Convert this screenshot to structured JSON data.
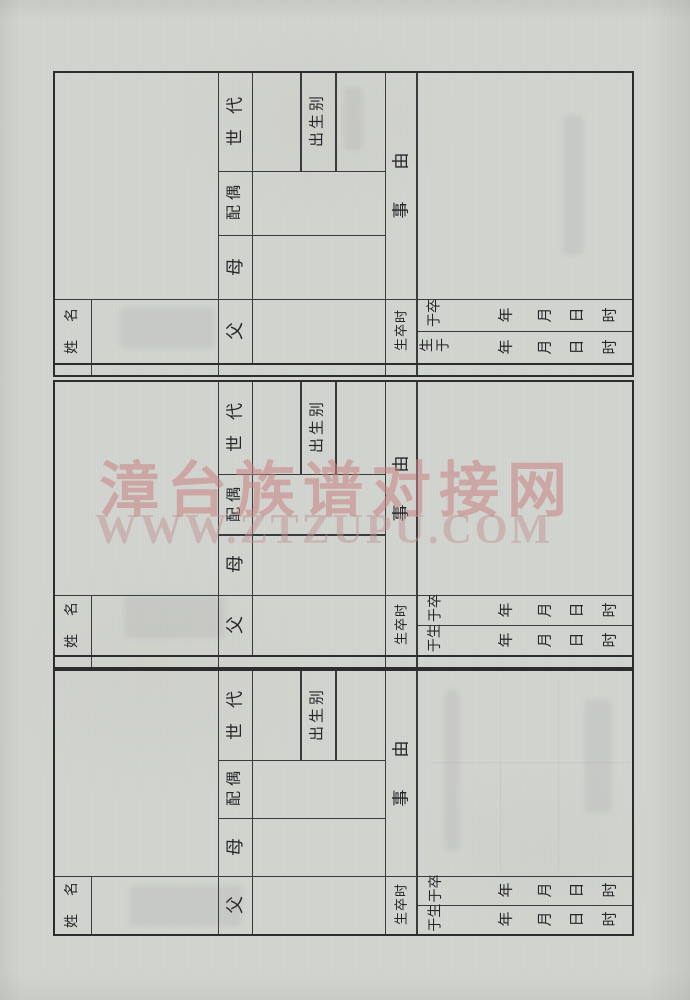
{
  "watermark": {
    "line1": "漳台族谱对接网",
    "line2": "WWW.ZTZUPU.COM",
    "color": "#c78282"
  },
  "form": {
    "sections_count": 3,
    "labels": {
      "full_name": "姓名",
      "father": "父",
      "mother": "母",
      "spouse": "配偶",
      "generation": "世代",
      "birth_order": "出生别",
      "matter": "事由",
      "birth_death_time": "生卒时",
      "died_on": "卒于",
      "born_on": "生于",
      "year": "年",
      "month": "月",
      "day": "日",
      "hour": "时"
    }
  },
  "colors": {
    "paper": "#d2d4cf",
    "ink": "#26262a",
    "grid_line": "#3b3b3e"
  }
}
